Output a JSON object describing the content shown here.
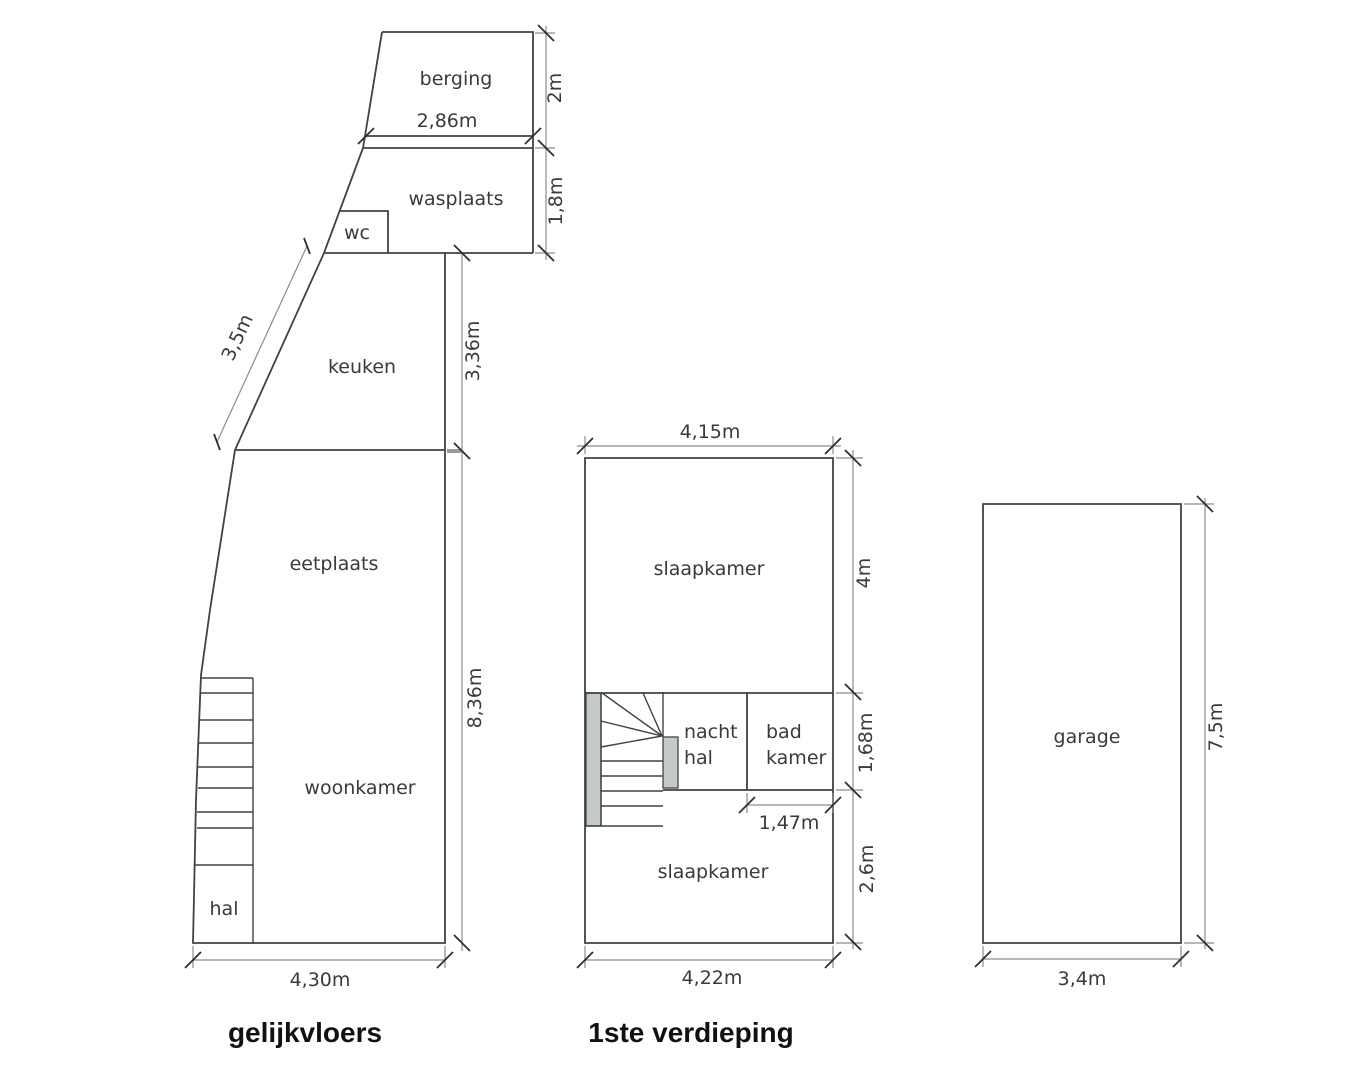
{
  "document": {
    "type": "architectural floor plan",
    "background": "#ffffff"
  },
  "colors": {
    "wall_line": "#424242",
    "dimension_line": "#8c8c8c",
    "tick_mark": "#2f2f2f",
    "label_text": "#3a3a3a",
    "title_text": "#111111",
    "stair_fill": "#c6c9c9"
  },
  "ground_floor": {
    "title": "gelijkvloers",
    "rooms": {
      "berging": "berging",
      "wasplaats": "wasplaats",
      "wc": "wc",
      "keuken": "keuken",
      "eetplaats": "eetplaats",
      "woonkamer": "woonkamer",
      "hal": "hal"
    },
    "dims": {
      "berging_width": "2,86m",
      "berging_depth": "2m",
      "wasplaats_depth": "1,8m",
      "west_wall": "3,5m",
      "keuken_depth": "3,36m",
      "main_depth": "8,36m",
      "total_width": "4,30m"
    }
  },
  "first_floor": {
    "title": "1ste verdieping",
    "rooms": {
      "slaapkamer_front": "slaapkamer",
      "nachthal_line1": "nacht",
      "nachthal_line2": "hal",
      "badkamer_line1": "bad",
      "badkamer_line2": "kamer",
      "slaapkamer_back": "slaapkamer"
    },
    "dims": {
      "width_top": "4,15m",
      "front_depth": "4m",
      "middle_depth": "1,68m",
      "badkamer_width": "1,47m",
      "back_depth": "2,6m",
      "width_bottom": "4,22m"
    }
  },
  "garage": {
    "room": "garage",
    "dims": {
      "depth": "7,5m",
      "width": "3,4m"
    }
  }
}
